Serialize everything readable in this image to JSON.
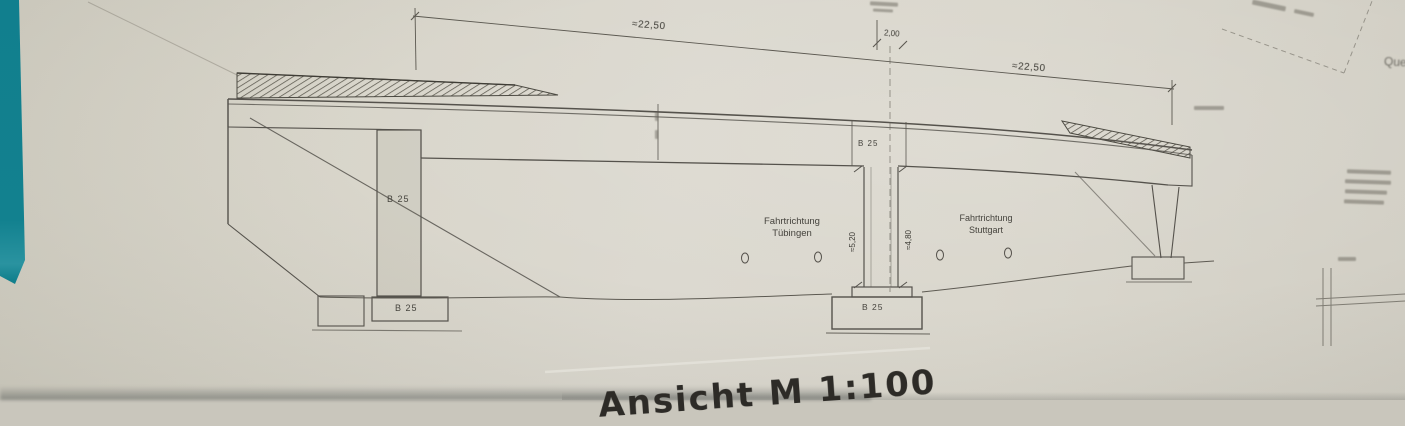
{
  "drawing": {
    "caption": "Ansicht M 1:100",
    "dims": {
      "span_left": "≈22,50",
      "span_right": "≈22,50",
      "gap": "2,00",
      "pier_left_height": "≈5,20",
      "pier_right_height": "≈4,80"
    },
    "texts": {
      "dir_left_1": "Fahrtrichtung",
      "dir_left_2": "Tübingen",
      "dir_right_1": "Fahrtrichtung",
      "dir_right_2": "Stuttgart",
      "b25_pier": "B 25",
      "b25_pier_footing": "B 25",
      "b25_deck": "B 25",
      "b25_center_footing": "B 25",
      "corner_note": "Quer"
    },
    "colors": {
      "table_surface": "#12808E",
      "paper": "#D8D5CB",
      "ink": "#55524C"
    }
  }
}
